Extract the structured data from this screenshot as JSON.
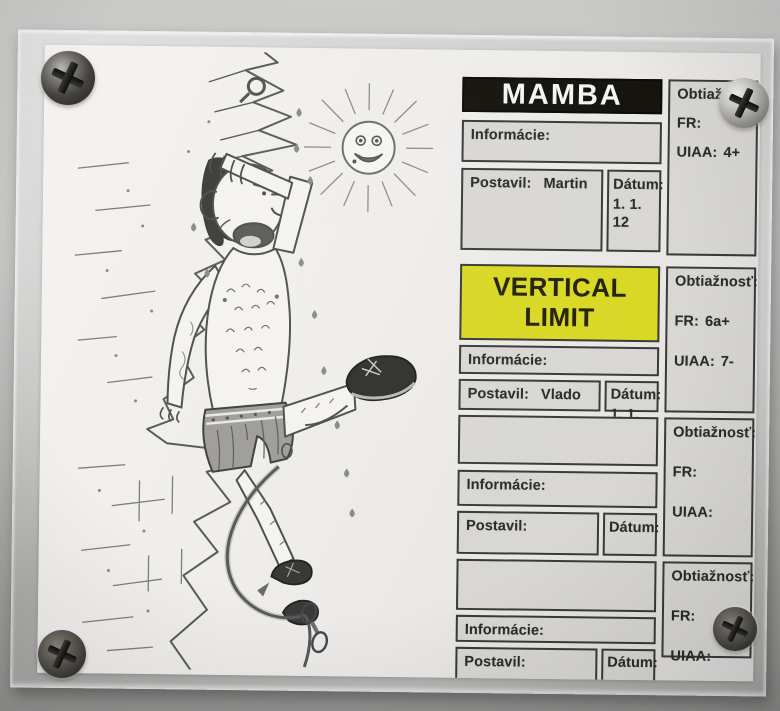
{
  "colors": {
    "wall_top": "#cacbc9",
    "wall_bottom": "#919190",
    "paper": "#efedeb",
    "cell_bg": "#d8d7d4",
    "cell_border": "#3a3a3a",
    "title_black_bg": "#16140e",
    "title_black_text": "#f4f4f2",
    "title_yellow_bg": "#d9d824",
    "title_yellow_text": "#23210a"
  },
  "board": {
    "blocks": [
      {
        "title": "MAMBA",
        "info_label": "Informácie:",
        "info_value": "",
        "postavil_label": "Postavil:",
        "postavil_value": "Martin",
        "datum_label": "Dátum:",
        "datum_value": "1. 1. 12",
        "difficulty_label": "Obtiažnosť:",
        "fr_label": "FR:",
        "fr_value": "",
        "uiaa_label": "UIAA:",
        "uiaa_value": "4+"
      },
      {
        "title": "VERTICAL LIMIT",
        "info_label": "Informácie:",
        "info_value": "",
        "postavil_label": "Postavil:",
        "postavil_value": "Vlado",
        "datum_label": "Dátum:",
        "datum_value": "1. 1. 12",
        "difficulty_label": "Obtiažnosť:",
        "fr_label": "FR:",
        "fr_value": "6a+",
        "uiaa_label": "UIAA:",
        "uiaa_value": "7-"
      },
      {
        "title": "",
        "info_label": "Informácie:",
        "info_value": "",
        "postavil_label": "Postavil:",
        "postavil_value": "",
        "datum_label": "Dátum:",
        "datum_value": "",
        "difficulty_label": "Obtiažnosť:",
        "fr_label": "FR:",
        "fr_value": "",
        "uiaa_label": "UIAA:",
        "uiaa_value": ""
      },
      {
        "title": "",
        "info_label": "Informácie:",
        "info_value": "",
        "postavil_label": "Postavil:",
        "postavil_value": "",
        "datum_label": "Dátum:",
        "datum_value": "",
        "difficulty_label": "Obtiažnosť:",
        "fr_label": "FR:",
        "fr_value": "",
        "uiaa_label": "UIAA:",
        "uiaa_value": ""
      }
    ]
  },
  "illustration": {
    "elements": [
      "rock-face",
      "bolt-hanger",
      "sun",
      "climber",
      "rope",
      "quickdraw"
    ]
  }
}
